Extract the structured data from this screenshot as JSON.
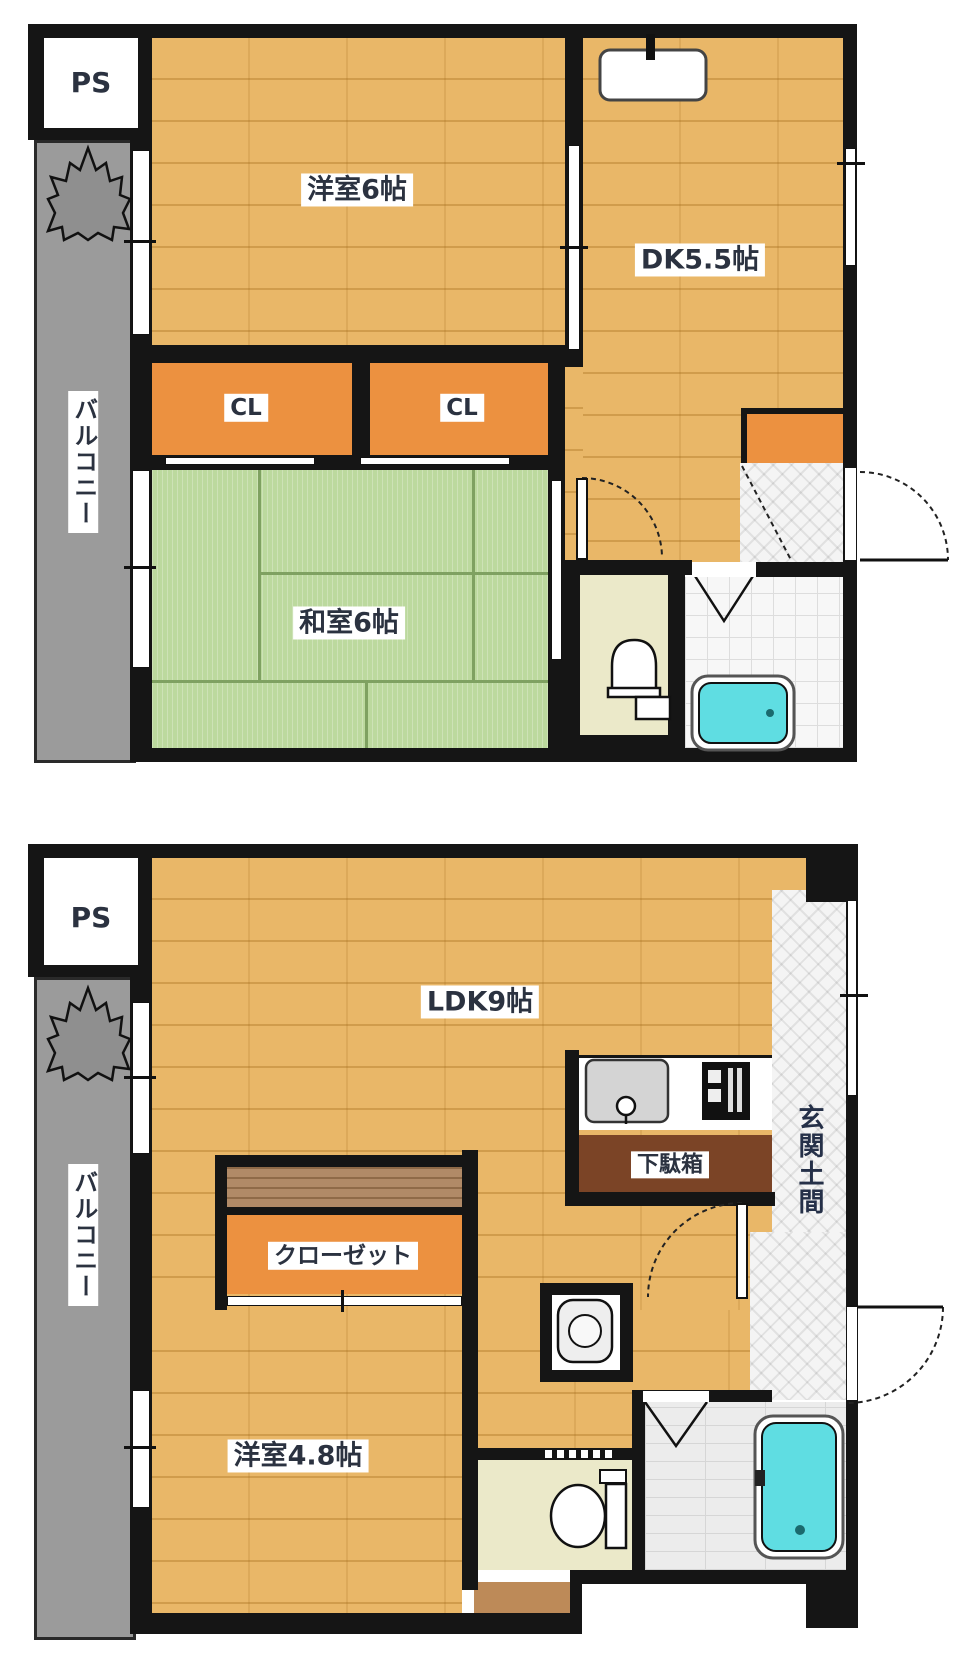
{
  "plans": [
    {
      "name": "upper-floor-plan",
      "rooms": {
        "ps": "PS",
        "balcony": "バルコニー",
        "western_room": "洋室6帖",
        "dining_kitchen": "DK5.5帖",
        "closet_left": "CL",
        "closet_right": "CL",
        "japanese_room": "和室6帖"
      }
    },
    {
      "name": "lower-floor-plan",
      "rooms": {
        "ps": "PS",
        "balcony": "バルコニー",
        "ldk": "LDK9帖",
        "shoe_cabinet": "下駄箱",
        "entrance_doma": "玄関土間",
        "closet": "クローゼット",
        "western_room": "洋室4.8帖"
      }
    }
  ],
  "colors": {
    "wall": "#151515",
    "wood": "#e9b768",
    "orange": "#ec9140",
    "tatami": "#bcd99e",
    "tatami_line": "#7fa161",
    "balcony": "#9b9b9b",
    "bathtub": "#5fdde2",
    "toilet_floor": "#ebe9c9",
    "shoe_cabinet": "#7b4426",
    "closet_shelf": "#b18a67",
    "label_text": "#2b3240"
  }
}
